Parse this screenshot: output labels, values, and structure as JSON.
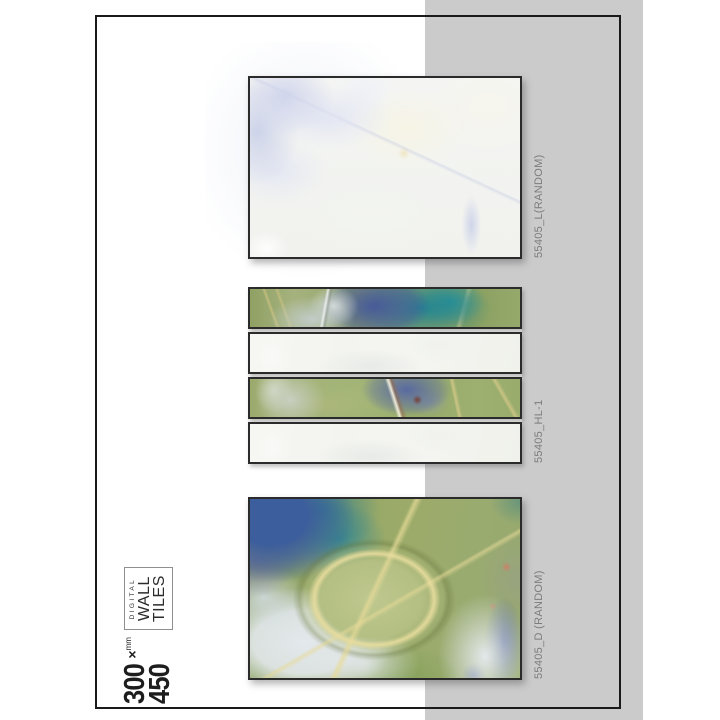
{
  "palette": {
    "canvas-bg": "#ffffff",
    "stripe": "#cbcbcb",
    "page-border": "#1a1a1a",
    "tile-border": "#2b2b2b",
    "label-text": "#7c7c7c",
    "branding-text": "#1d1d1d",
    "marble-green": "#9cae6f",
    "marble-teal": "#27929c",
    "marble-indigo": "#4a5c9e",
    "marble-gold": "#d8c98a",
    "marble-light": "#f4f5f1"
  },
  "branding": {
    "size_width": "300",
    "size_times": "×",
    "size_unit": "mm",
    "size_height": "450",
    "product_small": "DIGITAL",
    "product_line1": "WALL",
    "product_line2": "TILES"
  },
  "tiles": [
    {
      "code": "55405_L(RANDOM)"
    },
    {
      "code": "55405_HL-1"
    },
    {
      "code": "55405_D (RANDOM)"
    }
  ]
}
